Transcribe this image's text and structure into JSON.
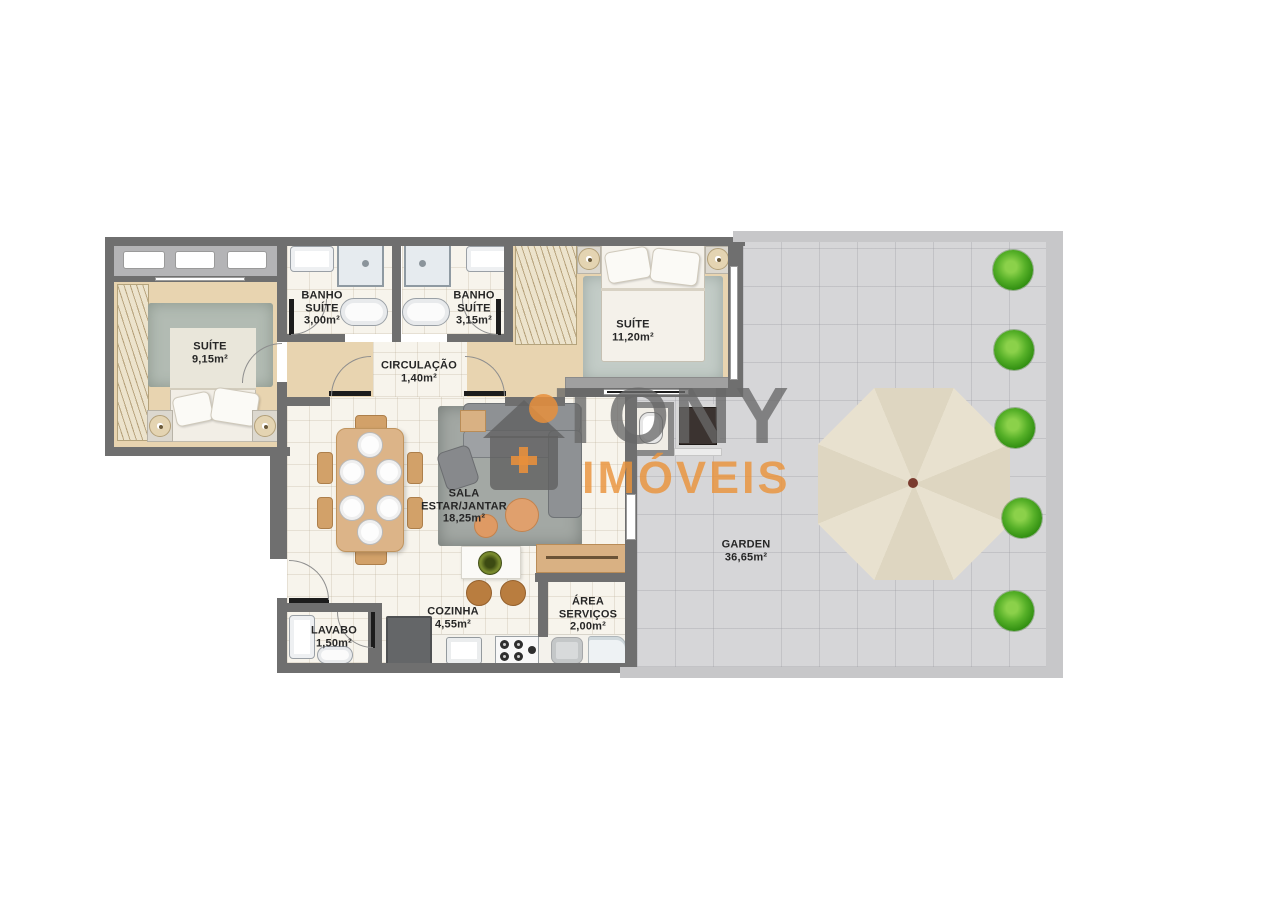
{
  "palette": {
    "wall_dark": "#6f6f6f",
    "wall_light": "#c7c7c9",
    "floor_wood": "#e8d4b0",
    "floor_tile": "#f7f4ec",
    "floor_garden": "#d6d6d8",
    "rug_green": "#b2bbb3",
    "umbrella": "#e6dfcc",
    "shrub_green": "#4aa81f",
    "accent_orange": "#e08b45",
    "watermark_gray": "#686868",
    "watermark_orange": "#e7923a",
    "label_text": "#262626"
  },
  "watermark": {
    "brand": "TONY",
    "brand2": "IMÓVEIS",
    "icon": "house-plus-icon"
  },
  "rooms": {
    "suite1": {
      "lines": [
        "SUÍTE",
        "9,15m²"
      ]
    },
    "banho_suite1": {
      "lines": [
        "BANHO",
        "SUÍTE",
        "3,00m²"
      ]
    },
    "banho_suite2": {
      "lines": [
        "BANHO",
        "SUÍTE",
        "3,15m²"
      ]
    },
    "circulacao": {
      "lines": [
        "CIRCULAÇÃO",
        "1,40m²"
      ]
    },
    "suite2": {
      "lines": [
        "SUÍTE",
        "11,20m²"
      ]
    },
    "sala": {
      "lines": [
        "SALA",
        "ESTAR/JANTAR",
        "18,25m²"
      ]
    },
    "garden": {
      "lines": [
        "GARDEN",
        "36,65m²"
      ]
    },
    "cozinha": {
      "lines": [
        "COZINHA",
        "4,55m²"
      ]
    },
    "area_servicos": {
      "lines": [
        "ÁREA",
        "SERVIÇOS",
        "2,00m²"
      ]
    },
    "lavabo": {
      "lines": [
        "LAVABO",
        "1,50m²"
      ]
    }
  },
  "garden_features": {
    "shrub_count": 5,
    "umbrella": "octagonal-parasol"
  },
  "icons": {
    "umbrella": "css-octagon",
    "shrub": "css-circle",
    "house_logo": "css-house-shape"
  }
}
